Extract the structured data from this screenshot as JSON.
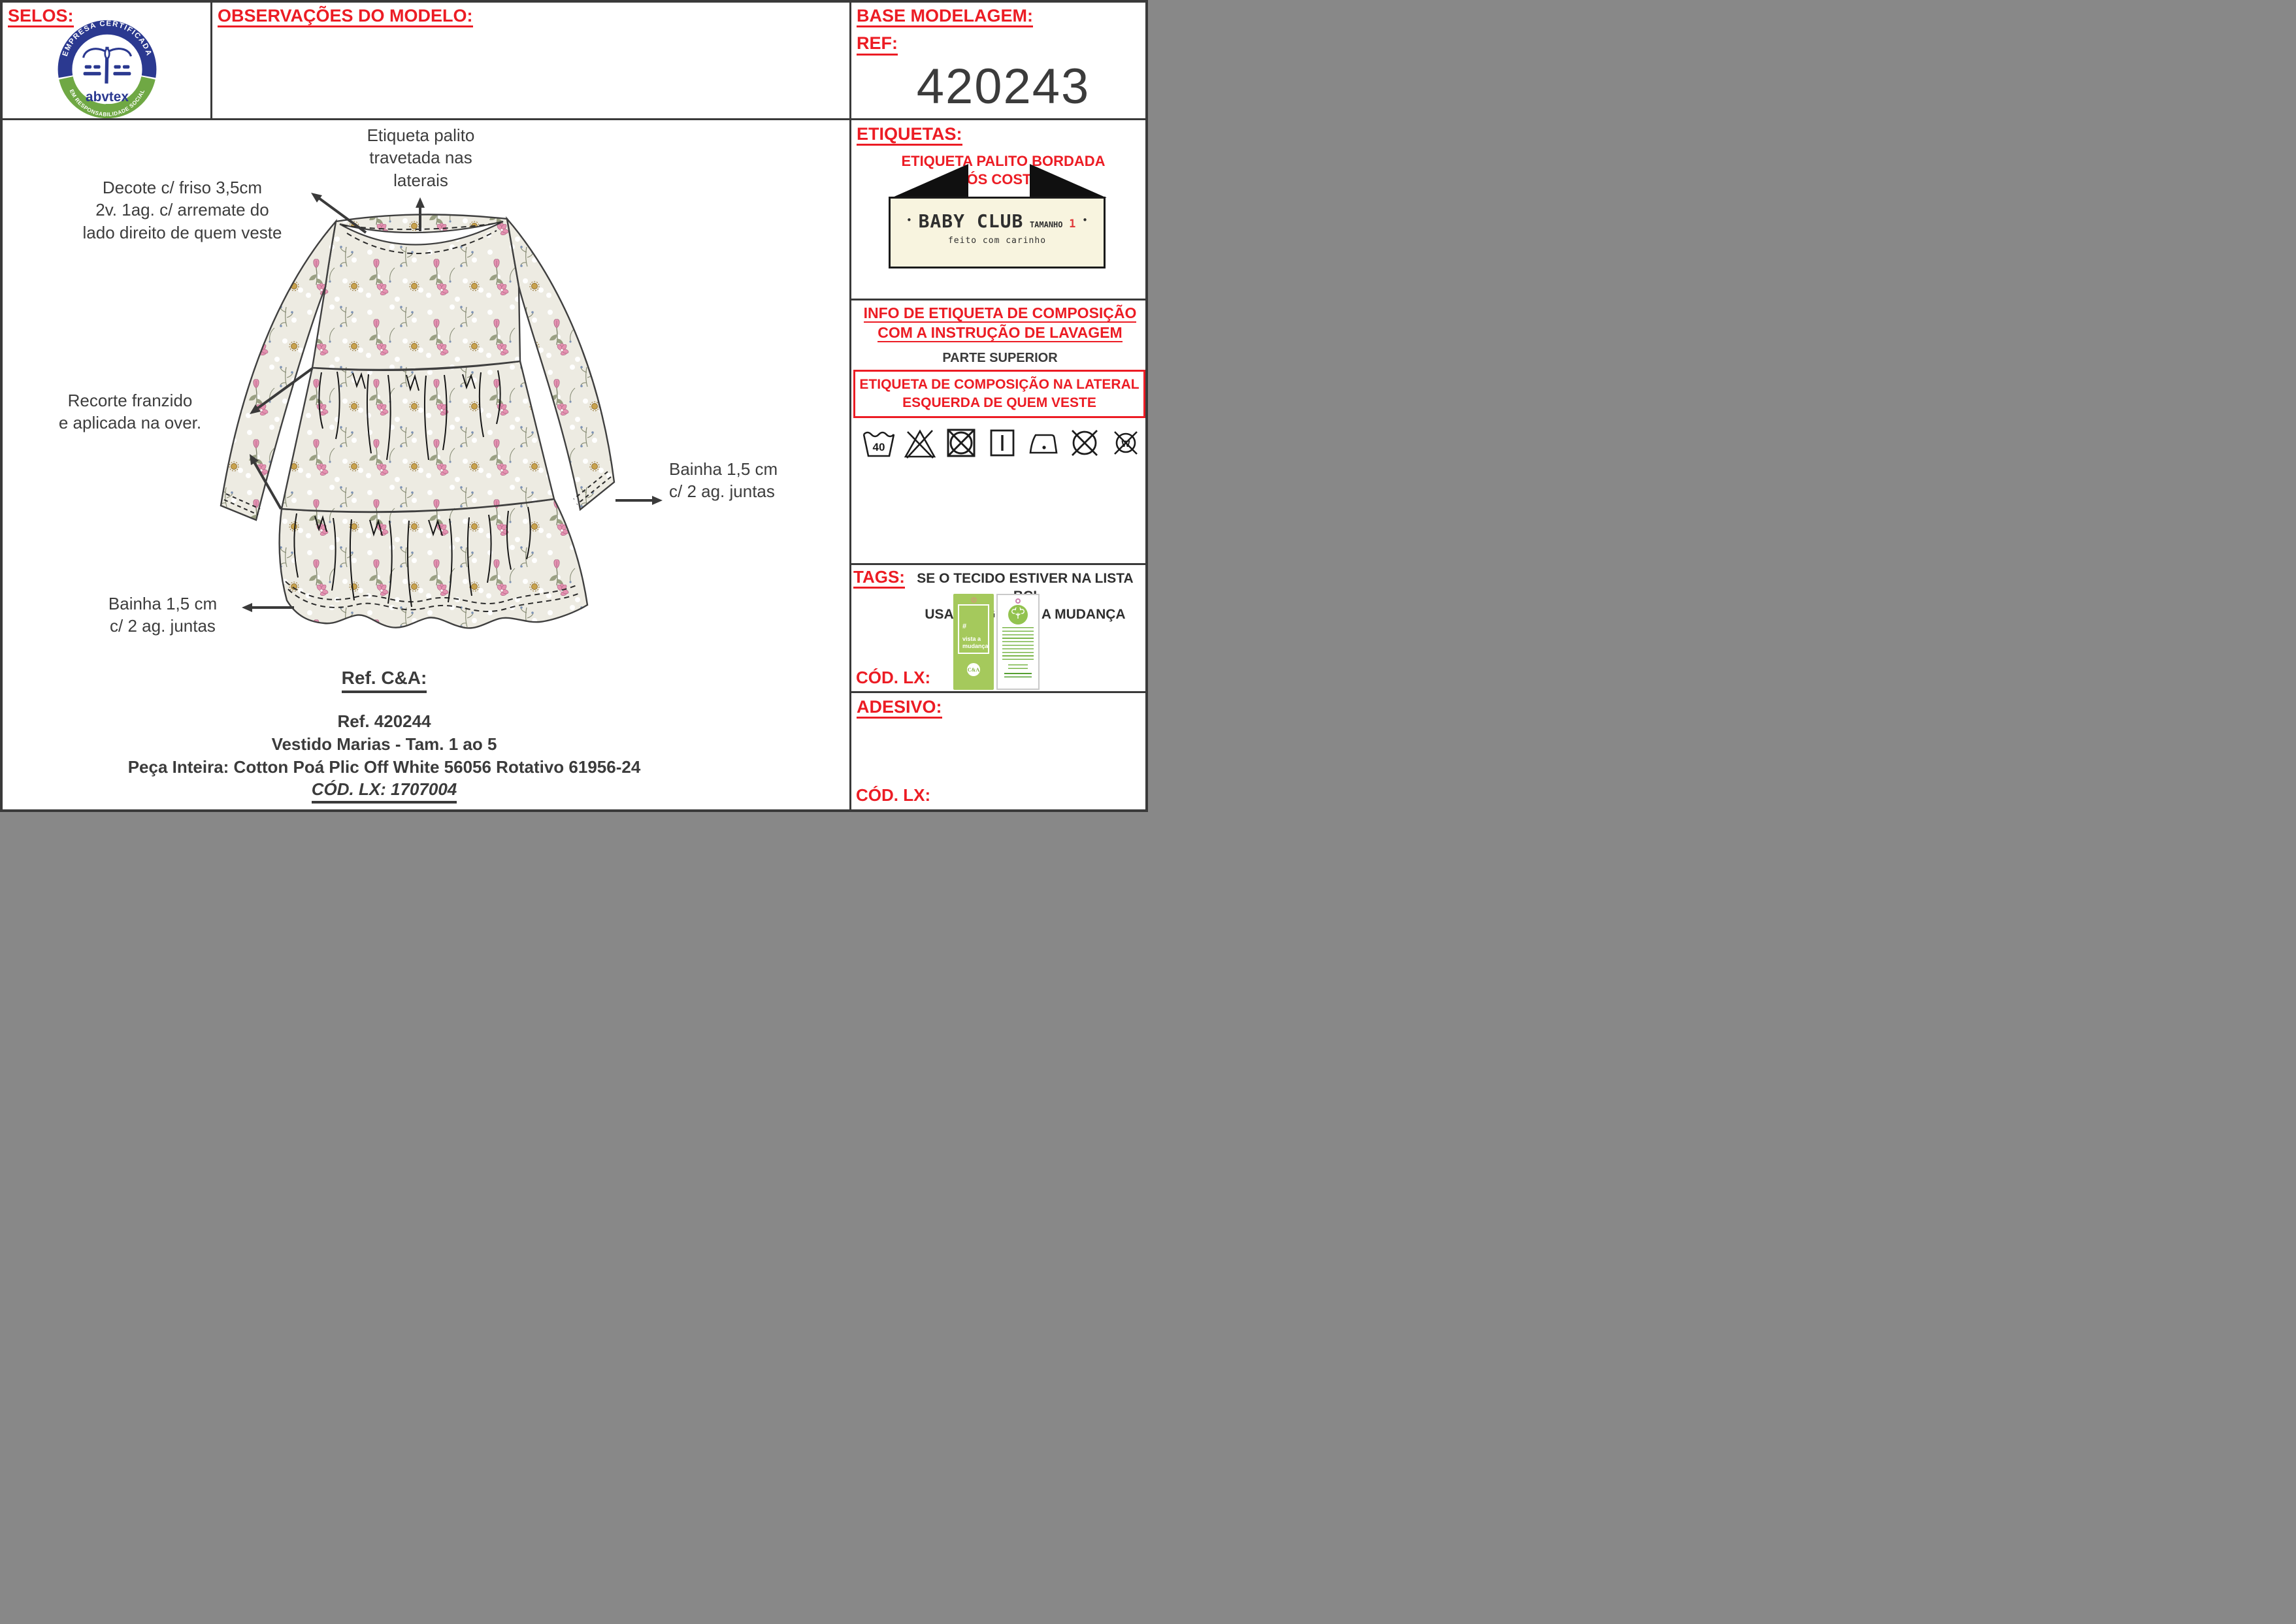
{
  "selos": {
    "title": "SELOS:"
  },
  "abvtex": {
    "arc_top": "EMPRESA CERTIFICADA",
    "arc_bottom": "EM RESPONSABILIDADE SOCIAL",
    "wordmark": "abvtex"
  },
  "observacoes": {
    "title": "OBSERVAÇÕES DO MODELO:"
  },
  "base_modelagem": {
    "title": "BASE MODELAGEM:",
    "ref_label": "REF:",
    "ref_value": "420243"
  },
  "etiquetas": {
    "title": "ETIQUETAS:",
    "subtitle_line1": "ETIQUETA PALITO BORDADA",
    "subtitle_line2": "(CÓS COSTAS)",
    "label": {
      "bullet_left": "•",
      "brand": "BABY CLUB",
      "size_label": "TAMANHO",
      "size_value": "1",
      "bullet_right": "•",
      "tagline": "feito com carinho"
    }
  },
  "info_composicao": {
    "title_line1": "INFO DE ETIQUETA DE COMPOSIÇÃO",
    "title_line2": "COM A INSTRUÇÃO DE LAVAGEM",
    "subtitle": "PARTE SUPERIOR",
    "box_line1": "ETIQUETA DE COMPOSIÇÃO NA LATERAL",
    "box_line2": "ESQUERDA DE QUEM VESTE",
    "wash_temperature": "40",
    "do_not_wet_clean_letter": "W",
    "care_symbols": [
      "wash-40",
      "do-not-bleach",
      "do-not-tumble-dry",
      "drip-dry",
      "iron-low",
      "do-not-dry-clean",
      "do-not-wet-clean"
    ]
  },
  "tags_section": {
    "title": "TAGS:",
    "note_line1": "SE O TECIDO ESTIVER NA LISTA BCI",
    "note_line2": "USAR TAG VISTA A MUDANÇA",
    "cod_lx_label": "CÓD. LX:",
    "green_tag": {
      "hashtag": "#",
      "line1": "vista a",
      "line2": "mudança",
      "logo": "C&A"
    }
  },
  "adesivo_section": {
    "title": "ADESIVO:",
    "cod_lx_label": "CÓD. LX:"
  },
  "annotations": {
    "etiqueta_palito": "Etiqueta palito\ntravetada nas\nlaterais",
    "decote": "Decote c/ friso 3,5cm\n2v. 1ag. c/ arremate do\nlado direito de quem veste",
    "recorte": "Recorte franzido\ne aplicada na over.",
    "bainha_right": "Bainha 1,5 cm\nc/ 2 ag. juntas",
    "bainha_left": "Bainha 1,5 cm\nc/ 2 ag. juntas"
  },
  "ref_block": {
    "title": "Ref. C&A:",
    "lines": "Ref. 420244\nVestido Marias - Tam. 1 ao 5\nPeça Inteira: Cotton Poá Plic Off White 56056 Rotativo 61956-24",
    "cod_lx": "CÓD. LX: 1707004"
  },
  "colors": {
    "red": "#ec1c24",
    "dark": "#3b3b3b",
    "fabric": "#edebe2",
    "floral_pink": "#e591b1",
    "foliage": "#878c74",
    "tag_green": "#a5c95c",
    "label_cream": "#f8f4df",
    "navy": "#2b3990",
    "logo_green": "#6fa844"
  }
}
